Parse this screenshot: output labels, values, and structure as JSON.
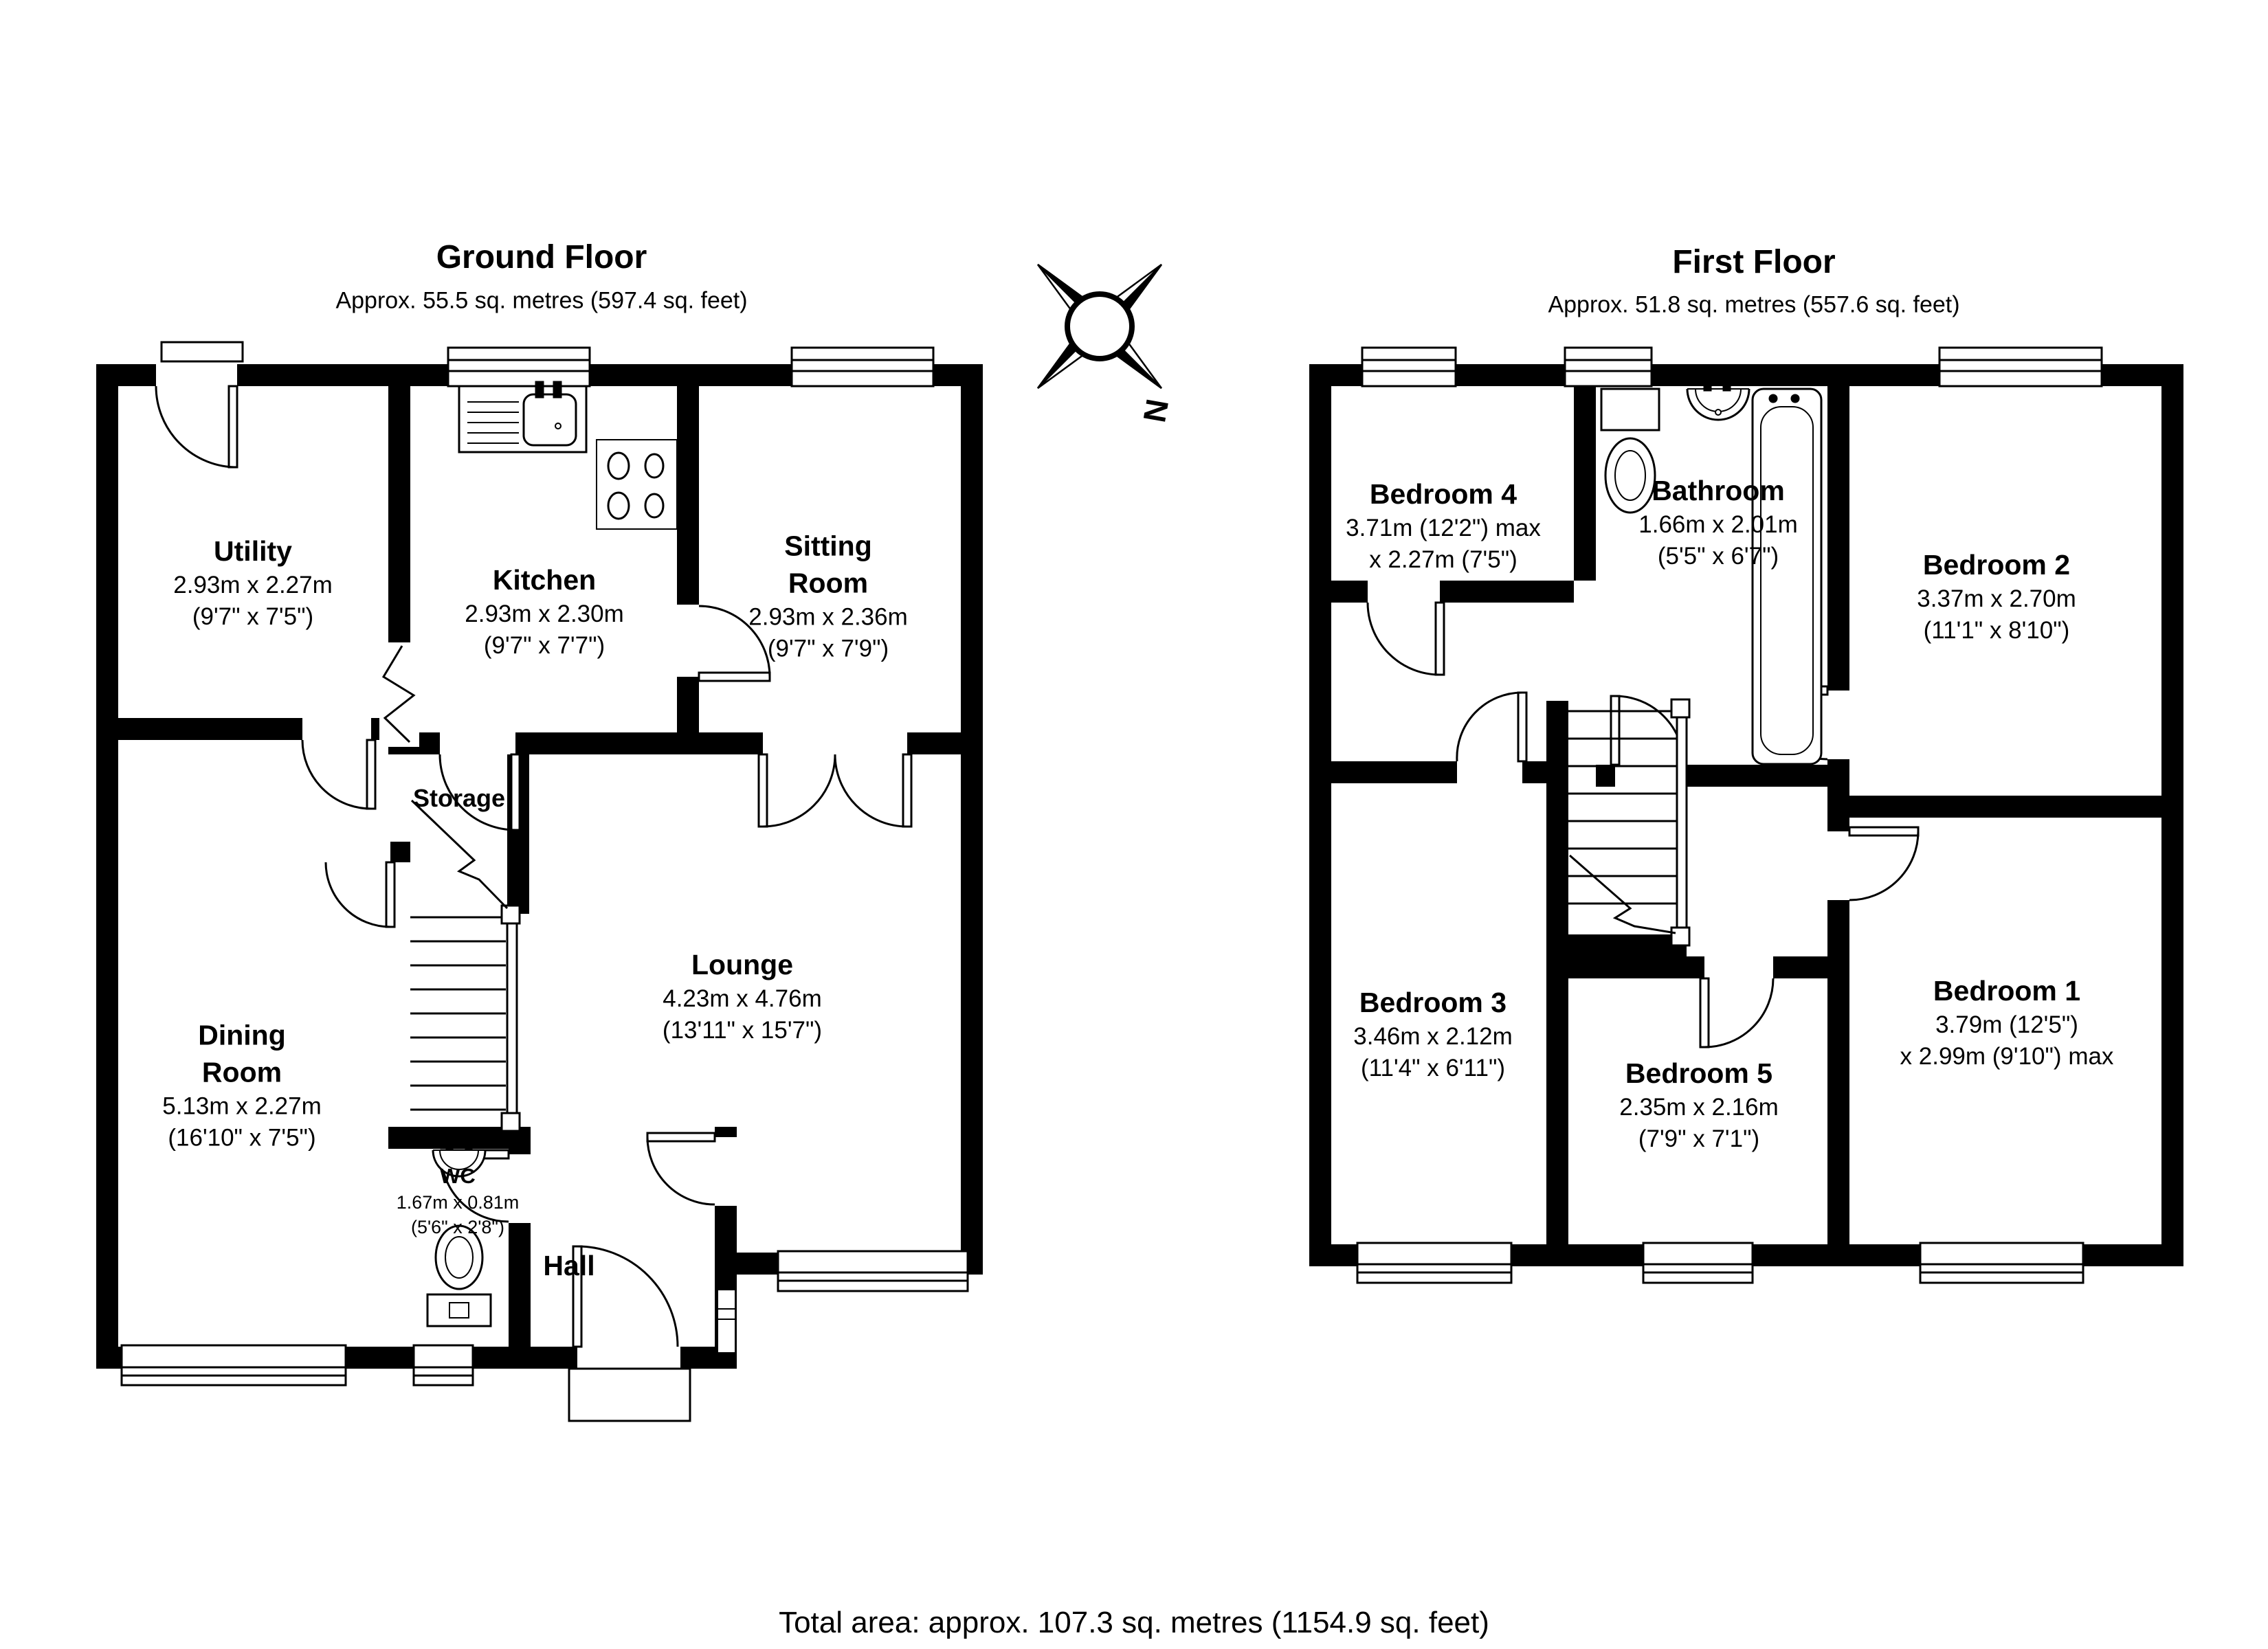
{
  "page": {
    "total_area": "Total area: approx. 107.3 sq. metres (1154.9 sq. feet)"
  },
  "compass": {
    "north_label": "N"
  },
  "ground_floor": {
    "title": "Ground Floor",
    "subtitle": "Approx. 55.5 sq. metres (597.4 sq. feet)",
    "rooms": {
      "utility": {
        "name": "Utility",
        "dims_m": "2.93m x 2.27m",
        "dims_ft": "(9'7\" x 7'5\")"
      },
      "kitchen": {
        "name": "Kitchen",
        "dims_m": "2.93m x 2.30m",
        "dims_ft": "(9'7\" x 7'7\")"
      },
      "sitting_room": {
        "name": "Sitting Room",
        "dims_m": "2.93m x 2.36m",
        "dims_ft": "(9'7\" x 7'9\")"
      },
      "lounge": {
        "name": "Lounge",
        "dims_m": "4.23m x 4.76m",
        "dims_ft": "(13'11\" x 15'7\")"
      },
      "dining_room": {
        "name": "Dining Room",
        "dims_m": "5.13m x 2.27m",
        "dims_ft": "(16'10\" x 7'5\")"
      },
      "storage": {
        "name": "Storage"
      },
      "wc": {
        "name": "WC",
        "dims_m": "1.67m x 0.81m",
        "dims_ft": "(5'6\" x 2'8\")"
      },
      "hall": {
        "name": "Hall"
      }
    }
  },
  "first_floor": {
    "title": "First Floor",
    "subtitle": "Approx. 51.8 sq. metres (557.6 sq. feet)",
    "rooms": {
      "bedroom4": {
        "name": "Bedroom 4",
        "dims_m": "3.71m (12'2\") max",
        "dims_ft": "x 2.27m (7'5\")"
      },
      "bathroom": {
        "name": "Bathroom",
        "dims_m": "1.66m x 2.01m",
        "dims_ft": "(5'5\" x 6'7\")"
      },
      "bedroom2": {
        "name": "Bedroom 2",
        "dims_m": "3.37m x 2.70m",
        "dims_ft": "(11'1\" x 8'10\")"
      },
      "bedroom3": {
        "name": "Bedroom 3",
        "dims_m": "3.46m x 2.12m",
        "dims_ft": "(11'4\" x 6'11\")"
      },
      "bedroom5": {
        "name": "Bedroom 5",
        "dims_m": "2.35m x 2.16m",
        "dims_ft": "(7'9\" x 7'1\")"
      },
      "bedroom1": {
        "name": "Bedroom 1",
        "dims_m": "3.79m (12'5\")",
        "dims_ft": "x 2.99m (9'10\") max"
      }
    }
  }
}
